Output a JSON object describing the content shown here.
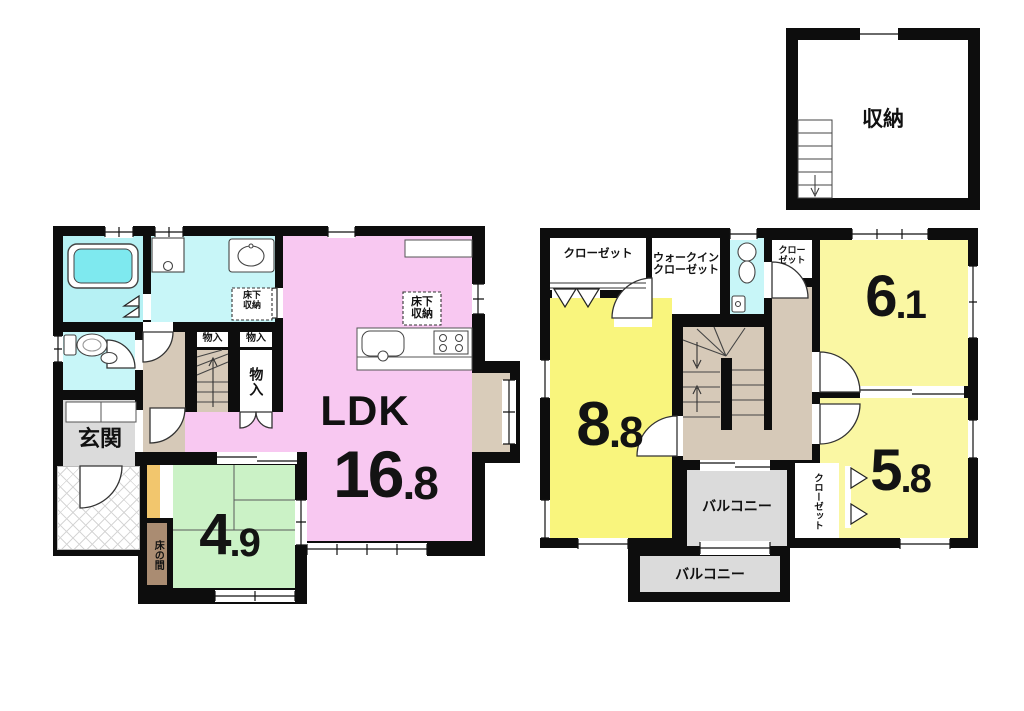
{
  "first_floor": {
    "ldk": {
      "label": "LDK",
      "size_main": "16",
      "size_dec": ".8"
    },
    "washitsu": {
      "size_main": "4",
      "size_dec": ".9"
    },
    "genkan": "玄関",
    "tokonoma": "床の間",
    "monoire_large": "物入",
    "monoire_small_1": "物入",
    "monoire_small_2": "物入",
    "yukashita_washroom": {
      "line1": "床下",
      "line2": "収納"
    },
    "yukashita_kitchen": {
      "line1": "床下",
      "line2": "収納"
    }
  },
  "second_floor": {
    "room_88": {
      "size_main": "8",
      "size_dec": ".8"
    },
    "room_61": {
      "size_main": "6",
      "size_dec": ".1"
    },
    "room_58": {
      "size_main": "5",
      "size_dec": ".8"
    },
    "closet_top": "クローゼット",
    "walkin_closet": {
      "line1": "ウォークイン",
      "line2": "クローゼット"
    },
    "closet_small": {
      "line1": "クロー",
      "line2": "ゼット"
    },
    "closet_58": "クローゼット",
    "balcony_1": "バルコニー",
    "balcony_2": "バルコニー"
  },
  "attic": {
    "storage": "収納"
  },
  "colors": {
    "wall_black": "#0d0d0d",
    "ldk_pink": "#F8C8F1",
    "room_yellow": "#F9F57D",
    "room_yellow_light": "#FAF7A3",
    "tatami_green": "#CBF2C6",
    "bath_cyan": "#B6F1F4",
    "water_cyan": "#C8F6F8",
    "bathtub_cyan": "#7EE9EF",
    "hall_tan": "#D6C9B8",
    "bay_beige": "#D9CCBA",
    "balcony_gray": "#DBDBDB",
    "entrance_gray": "#DBDBDB",
    "tokonoma_brown": "#AA8C72",
    "tokonoma_shelf_orange": "#F2C66D"
  }
}
